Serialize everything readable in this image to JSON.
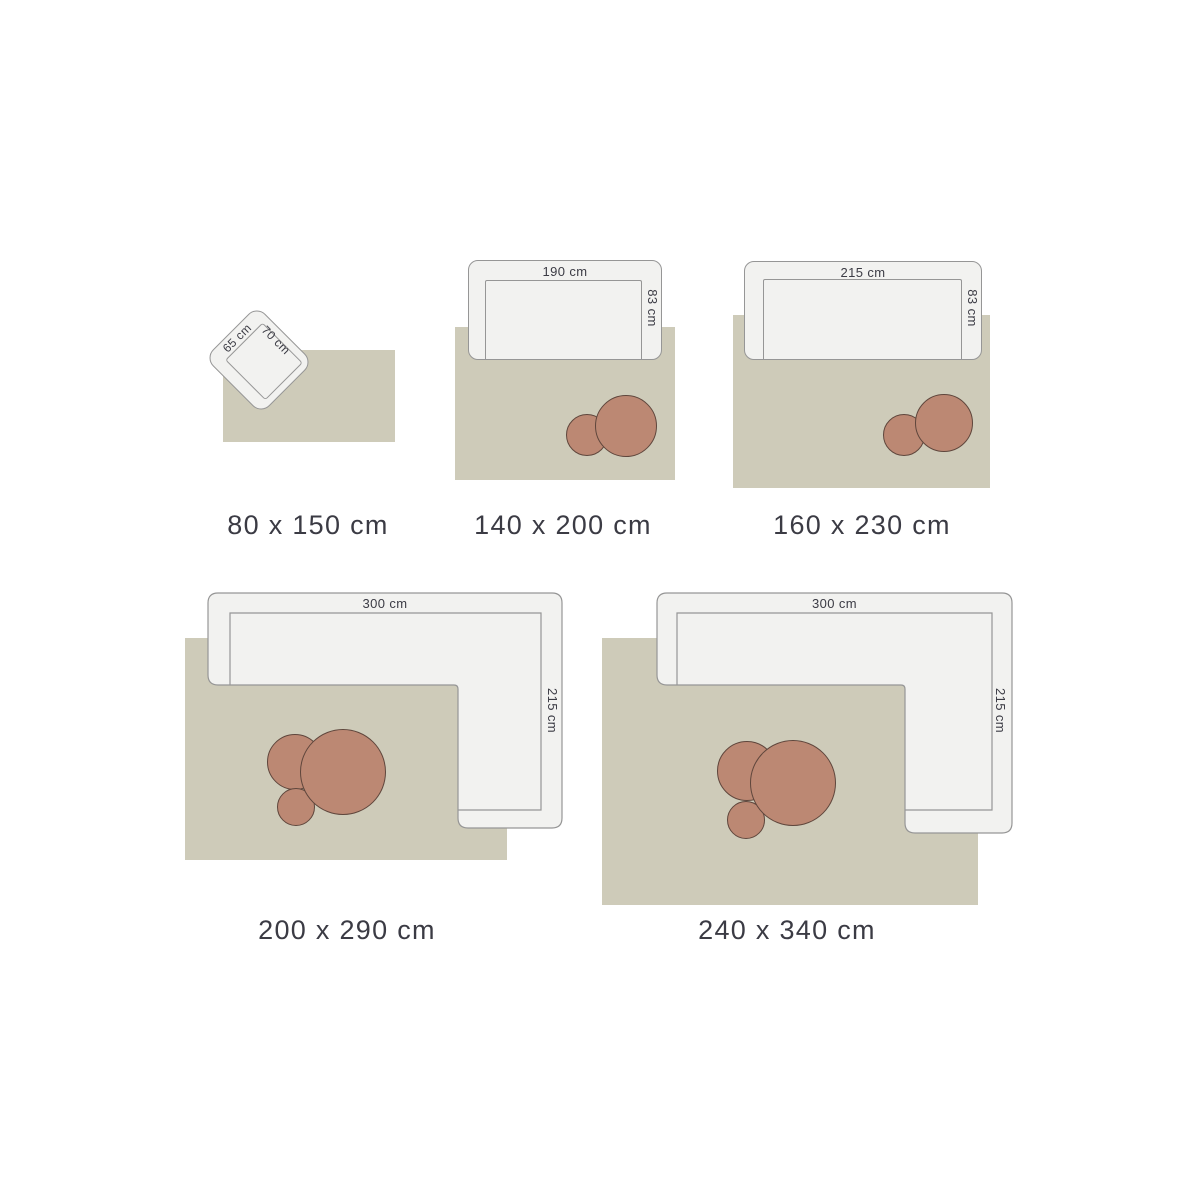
{
  "title": "rug-size-guide",
  "colors": {
    "background": "#ffffff",
    "rug": "#cecbb9",
    "furniture_fill": "#f2f2f0",
    "furniture_border": "#969696",
    "table_fill": "#bc8873",
    "table_border": "#5f463c",
    "text": "#3b3b44"
  },
  "diagrams": [
    {
      "size_label": "80 x 150 cm",
      "chair": {
        "width_label": "65 cm",
        "depth_label": "70 cm"
      }
    },
    {
      "size_label": "140 x 200 cm",
      "sofa": {
        "width_label": "190 cm",
        "depth_label": "83 cm"
      },
      "tables": [
        "small",
        "large"
      ]
    },
    {
      "size_label": "160 x 230 cm",
      "sofa": {
        "width_label": "215 cm",
        "depth_label": "83 cm"
      },
      "tables": [
        "small",
        "large"
      ]
    },
    {
      "size_label": "200 x 290 cm",
      "sofa": {
        "width_label": "300 cm",
        "depth_label": "215 cm"
      },
      "tables": [
        "medium",
        "small",
        "large"
      ]
    },
    {
      "size_label": "240 x 340 cm",
      "sofa": {
        "width_label": "300 cm",
        "depth_label": "215 cm"
      },
      "tables": [
        "medium",
        "small",
        "large"
      ]
    }
  ]
}
